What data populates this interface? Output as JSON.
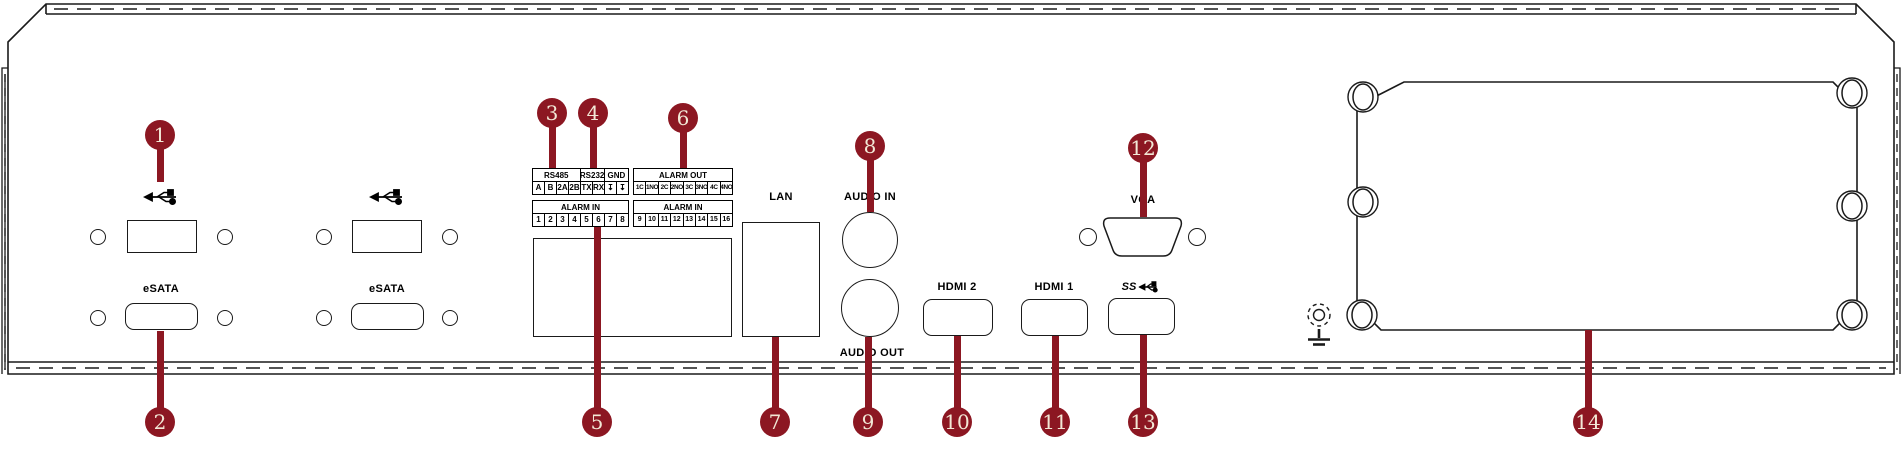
{
  "colors": {
    "accent": "#8c1722",
    "line": "#1a1a1a",
    "callout_text": "#f2e8d6"
  },
  "callouts": [
    {
      "num": "1"
    },
    {
      "num": "2"
    },
    {
      "num": "3"
    },
    {
      "num": "4"
    },
    {
      "num": "5"
    },
    {
      "num": "6"
    },
    {
      "num": "7"
    },
    {
      "num": "8"
    },
    {
      "num": "9"
    },
    {
      "num": "10"
    },
    {
      "num": "11"
    },
    {
      "num": "12"
    },
    {
      "num": "13"
    },
    {
      "num": "14"
    }
  ],
  "labels": {
    "esata_1": "eSATA",
    "esata_2": "eSATA",
    "lan": "LAN",
    "audio_in": "AUDIO IN",
    "audio_out": "AUDIO OUT",
    "hdmi_2": "HDMI 2",
    "hdmi_1": "HDMI 1",
    "vga": "VGA",
    "usb3_ss": "SS"
  },
  "icons": {
    "usb": "usb-trident-icon",
    "usb3": "usb3-superspeed-icon",
    "ground": "earth-ground-icon"
  },
  "terminal": {
    "serial": {
      "headers": [
        "RS485",
        "RS232",
        "GND"
      ],
      "pins": [
        "A",
        "B",
        "2A",
        "2B",
        "TX",
        "RX",
        "↧",
        "↧"
      ]
    },
    "alarm_in_left": {
      "header": "ALARM IN",
      "pins": [
        "1",
        "2",
        "3",
        "4",
        "5",
        "6",
        "7",
        "8"
      ]
    },
    "alarm_out": {
      "header": "ALARM OUT",
      "pins": [
        "1C",
        "1NO",
        "2C",
        "2NO",
        "3C",
        "3NO",
        "4C",
        "4NO"
      ]
    },
    "alarm_in_right": {
      "header": "ALARM IN",
      "pins": [
        "9",
        "10",
        "11",
        "12",
        "13",
        "14",
        "15",
        "16"
      ]
    }
  }
}
